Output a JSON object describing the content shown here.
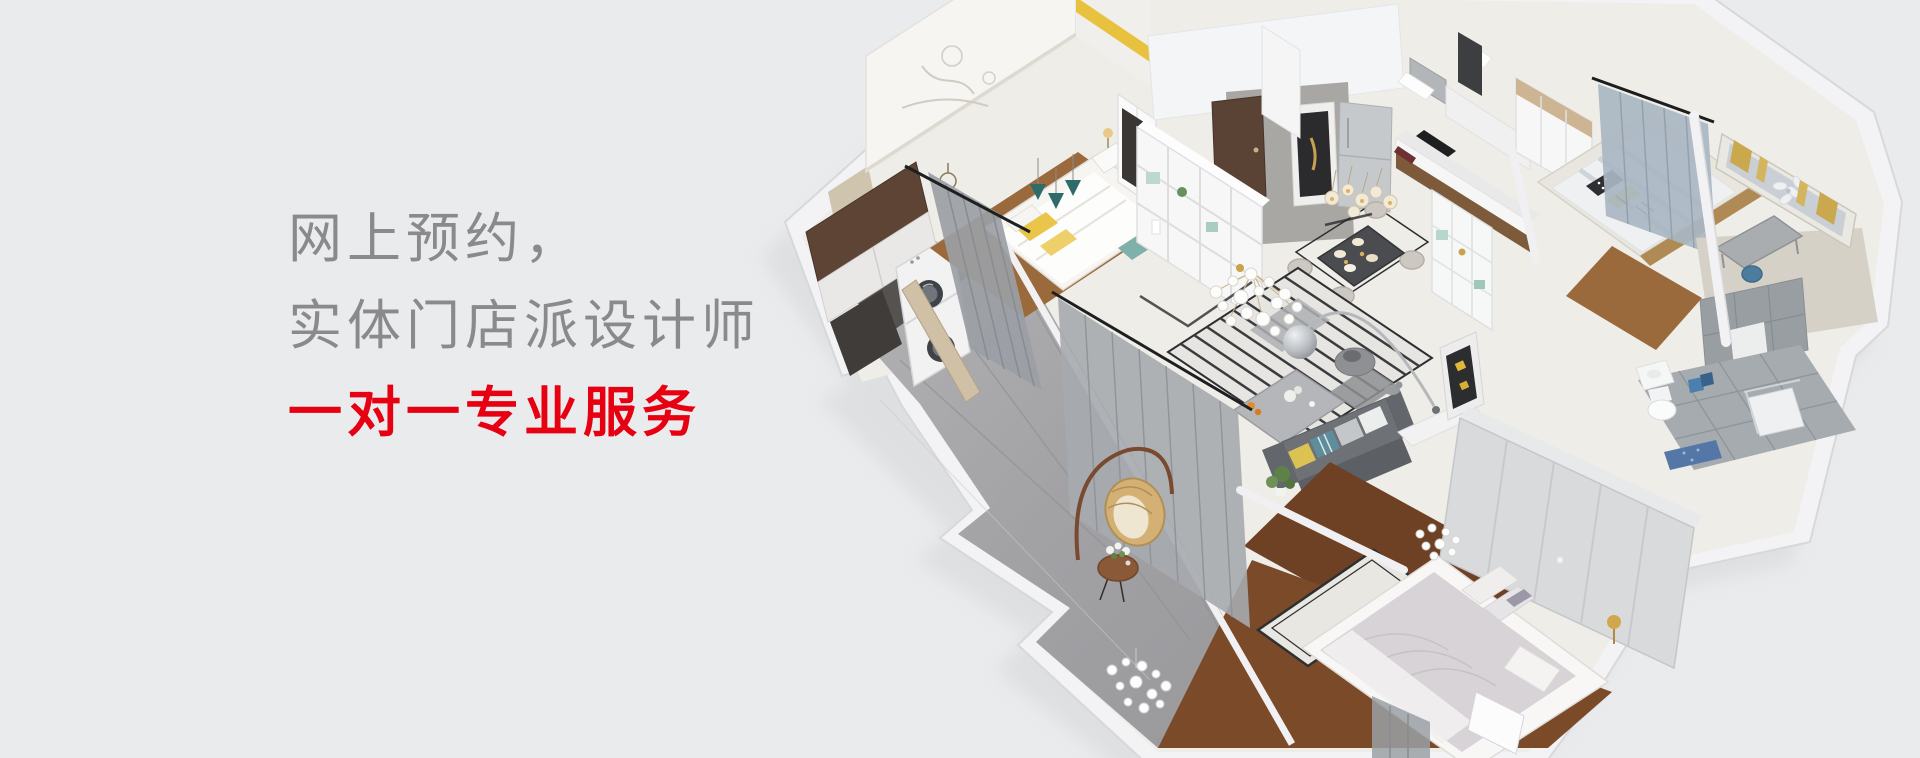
{
  "page": {
    "width_px": 1920,
    "height_px": 758,
    "background_color": "#eaebed"
  },
  "hero": {
    "line1": "网上预约，",
    "line2": "实体门店派设计师",
    "line3": "一对一专业服务",
    "primary_text_color": "#8a8a8c",
    "accent_text_color": "#e60012"
  },
  "illustration": {
    "kind": "isometric-apartment-cutaway-render",
    "rooms_depicted": [
      "laundry-utility-corner",
      "bedroom-with-mural-wall",
      "entry-hallway",
      "kitchen",
      "dining-area",
      "living-room",
      "tatami-bedroom",
      "study-nook",
      "bathroom",
      "master-bedroom",
      "balcony-corridor"
    ],
    "palette": {
      "outer_wall": "#f3f3f5",
      "wall_edge": "#d7d8da",
      "floor_ivory": "#efede7",
      "floor_marble_gray": "#a7a7aa",
      "floor_wood": "#9a6a3c",
      "floor_wood_dark": "#6e4124",
      "floor_tile_gray": "#a6abaf",
      "cabinet_brown": "#5d4435",
      "sofa_gray": "#6e7277",
      "curtain_gray": "#a3a7ac",
      "accent_teal": "#2f6b68",
      "accent_yellow": "#e9c64a",
      "accent_gold": "#c9a84e",
      "accent_blue": "#4a7fae"
    }
  }
}
